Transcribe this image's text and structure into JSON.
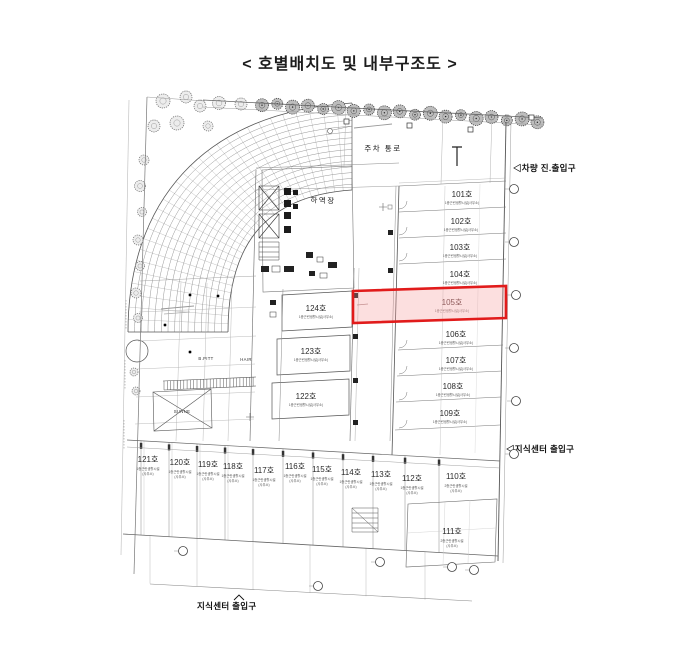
{
  "title": "< 호별배치도 및 내부구조도 >",
  "colors": {
    "highlight_border": "#e11b1b",
    "highlight_fill": "#f6baba",
    "drawing_line": "#555555"
  },
  "annotations": {
    "vehicle_entrance": "◁차량 진.출입구",
    "center_entrance_right": "◁지식센터 출입구",
    "center_entrance_bottom": "지식센터 출입구",
    "parking_corridor": "주차 통로",
    "loading_dock": "하역장"
  },
  "tenants": {
    "tenant_1": "B.PITT",
    "tenant_2": "HAIR",
    "tenant_3": "SUNNE"
  },
  "selected_unit": {
    "no": "105호",
    "sub": "1종근린생활시설(사무소)"
  },
  "units": {
    "right_column": [
      {
        "no": "101호",
        "sub": "1종근린생활시설(사무소)"
      },
      {
        "no": "102호",
        "sub": "1종근린생활시설(사무소)"
      },
      {
        "no": "103호",
        "sub": "1종근린생활시설(사무소)"
      },
      {
        "no": "104호",
        "sub": "1종근린생활시설(사무소)"
      },
      {
        "no": "106호",
        "sub": "1종근린생활시설(사무소)"
      },
      {
        "no": "107호",
        "sub": "1종근린생활시설(사무소)"
      },
      {
        "no": "108호",
        "sub": "1종근린생활시설(사무소)"
      },
      {
        "no": "109호",
        "sub": "1종근린생활시설(사무소)"
      }
    ],
    "middle_column": [
      {
        "no": "124호",
        "sub": "1종근린생활시설(사무소)"
      },
      {
        "no": "123호",
        "sub": "1종근린생활시설(사무소)"
      },
      {
        "no": "122호",
        "sub": "1종근린생활시설(사무소)"
      }
    ],
    "bottom_row": [
      {
        "no": "121호",
        "sub1": "1종근린생활시설",
        "sub2": "(사무소)"
      },
      {
        "no": "120호",
        "sub1": "1종근린생활시설",
        "sub2": "(사무소)"
      },
      {
        "no": "119호",
        "sub1": "1종근린생활시설",
        "sub2": "(사무소)"
      },
      {
        "no": "118호",
        "sub1": "1종근린생활시설",
        "sub2": "(사무소)"
      },
      {
        "no": "117호",
        "sub1": "1종근린생활시설",
        "sub2": "(사무소)"
      },
      {
        "no": "116호",
        "sub1": "1종근린생활시설",
        "sub2": "(사무소)"
      },
      {
        "no": "115호",
        "sub1": "1종근린생활시설",
        "sub2": "(사무소)"
      },
      {
        "no": "114호",
        "sub1": "1종근린생활시설",
        "sub2": "(사무소)"
      },
      {
        "no": "113호",
        "sub1": "1종근린생활시설",
        "sub2": "(사무소)"
      },
      {
        "no": "112호",
        "sub1": "1종근린생활시설",
        "sub2": "(사무소)"
      },
      {
        "no": "110호",
        "sub1": "2종근린생활시설",
        "sub2": "(사무소)"
      }
    ],
    "lower_right": [
      {
        "no": "111호",
        "sub1": "2종근린생활시설",
        "sub2": "(사무소)"
      }
    ]
  }
}
